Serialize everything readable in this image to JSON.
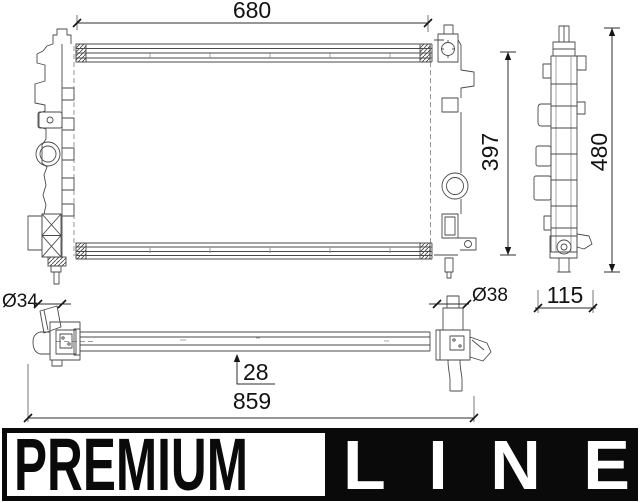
{
  "dimensions": {
    "core_width": "680",
    "core_height": "397",
    "overall_height": "480",
    "side_depth": "115",
    "inlet_diameter": "Ø34",
    "outlet_diameter": "Ø38",
    "core_depth": "28",
    "overall_length": "859"
  },
  "logo": {
    "premium": "PREMIUM",
    "line": "LINE"
  },
  "colors": {
    "line_art": "#4a4a4a",
    "dimension_text": "#131313",
    "logo_foreground": "#0a0a0a",
    "logo_background": "#ffffff",
    "page_background": "#ffffff"
  }
}
